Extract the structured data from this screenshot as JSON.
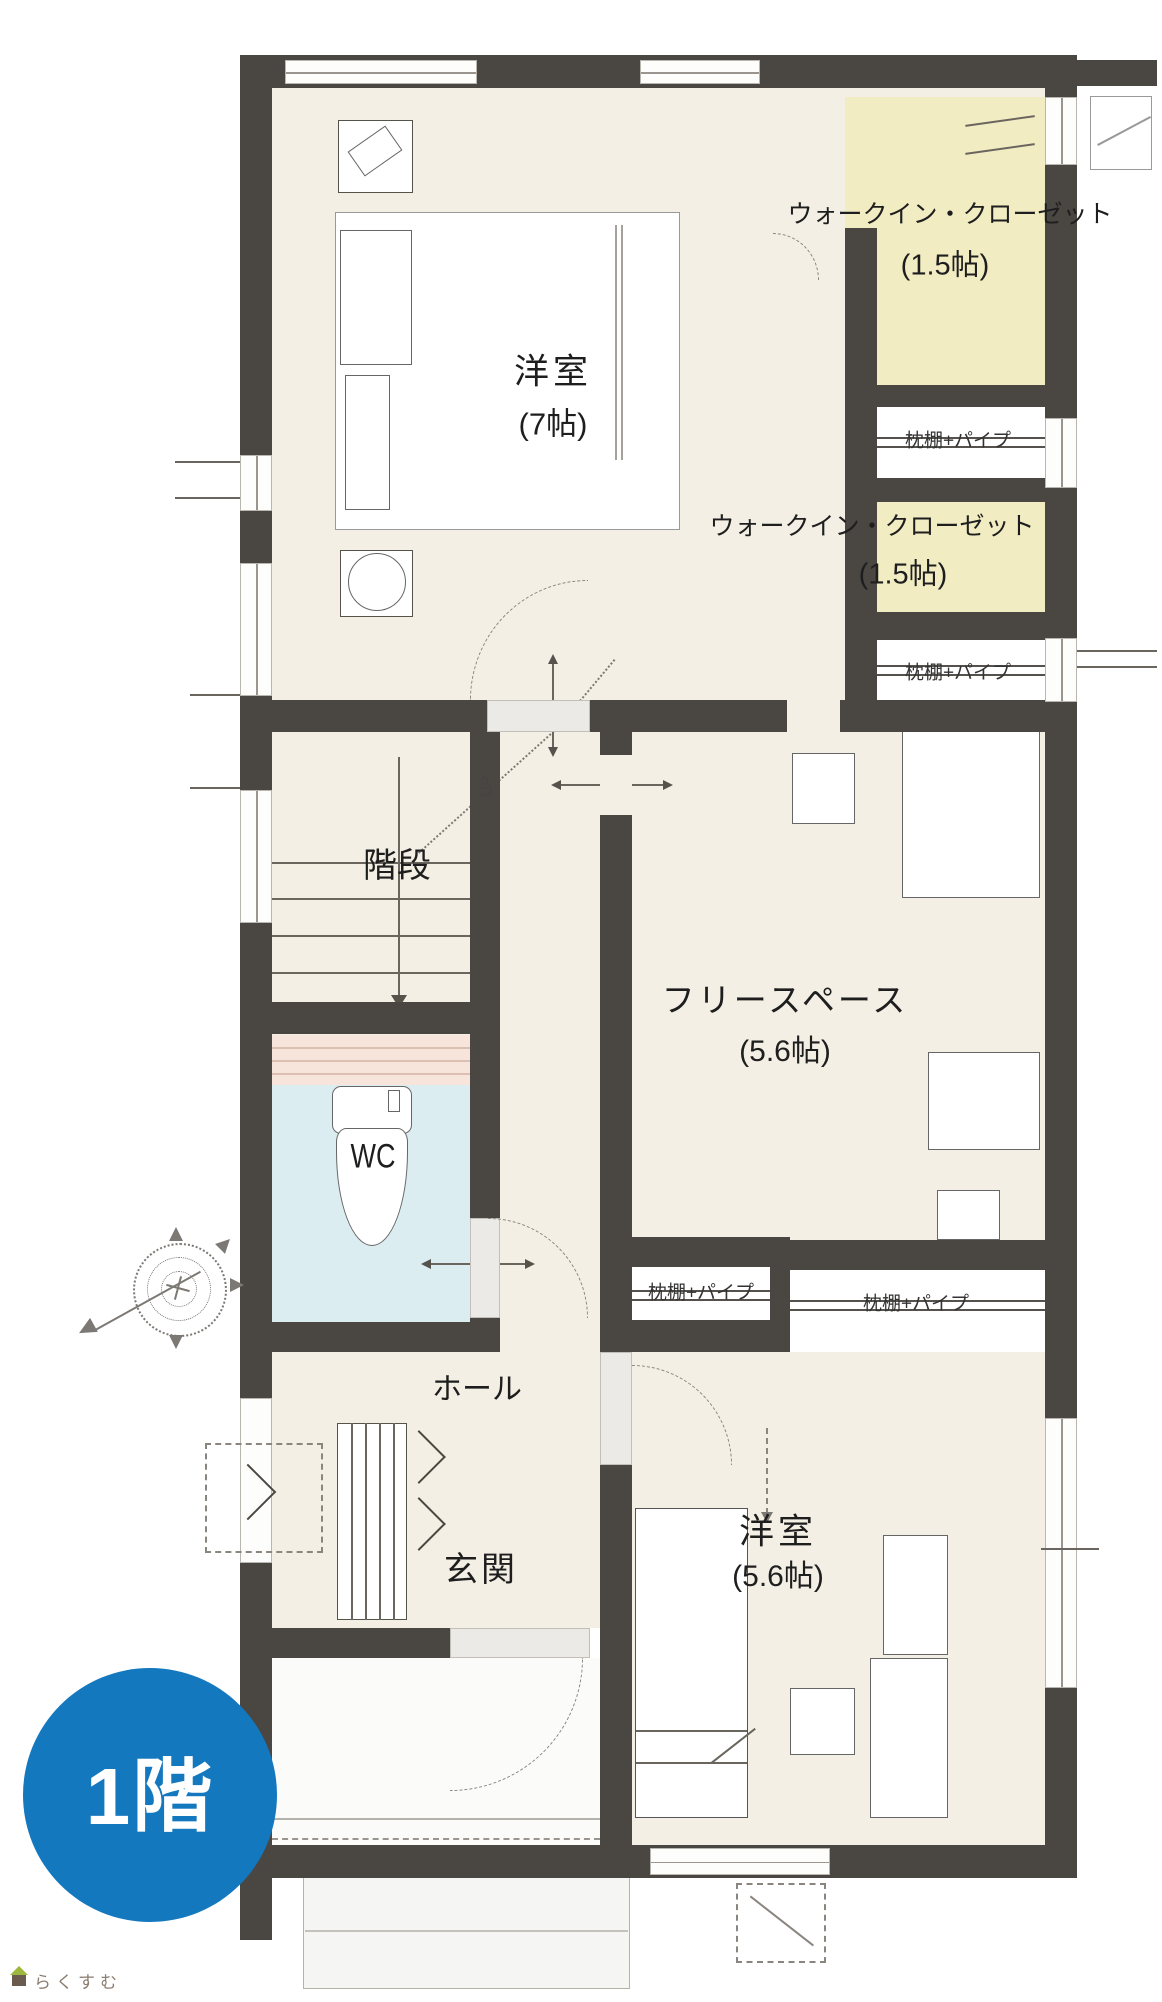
{
  "floor_badge": "1階",
  "watermark": "らくすむ",
  "labels": {
    "bedroom7": {
      "name": "洋室",
      "size": "(7帖)"
    },
    "wic_top": {
      "name": "ウォークイン・クローゼット",
      "size": "(1.5帖)"
    },
    "wic_mid": {
      "name": "ウォークイン・クローゼット",
      "size": "(1.5帖)"
    },
    "closet_shelf": "枕棚+パイプ",
    "freespace": {
      "name": "フリースペース",
      "size": "(5.6帖)"
    },
    "bedroom56": {
      "name": "洋室",
      "size": "(5.6帖)"
    },
    "stairs": "階段",
    "stairs_direction": "UP",
    "wc": "WC",
    "hall": "ホール",
    "genkan": "玄関"
  },
  "icons": {
    "compass": "compass-rose-icon",
    "watermark_logo": "house-icon"
  },
  "colors": {
    "wall": "#4a4642",
    "floor_beige": "#f3efe4",
    "wic_yellow": "#f2ecc3",
    "wc_blue": "#dcedf2",
    "shelf_pink": "#f7e4da",
    "badge_blue": "#1478bf",
    "watermark_text": "#8b7d70",
    "watermark_roof": "#9db83c"
  }
}
